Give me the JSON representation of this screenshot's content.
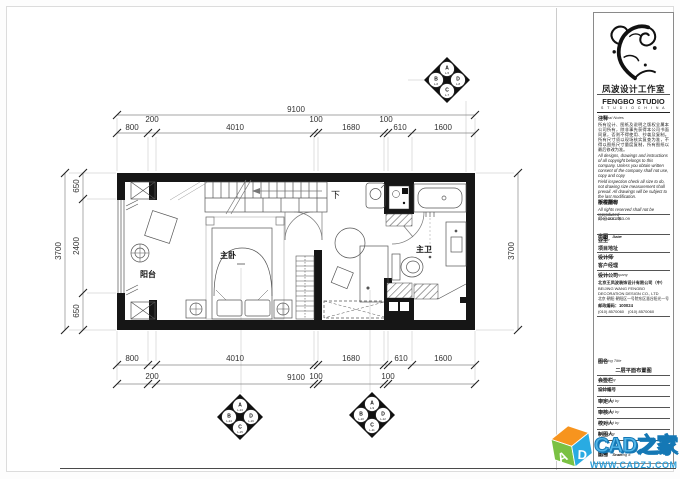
{
  "plan": {
    "rooms": {
      "balcony": "阳台",
      "bedroom": "主卧",
      "bathroom": "主卫",
      "stair_down": "下"
    },
    "dims": {
      "top": {
        "overall": "9100",
        "d800": "800",
        "d200": "200",
        "d4010": "4010",
        "d100a": "100",
        "d1680": "1680",
        "d100b": "100",
        "d610": "610",
        "d1600": "1600"
      },
      "bottom": {
        "overall": "9100",
        "d800": "800",
        "d200": "200",
        "d4010": "4010",
        "d100a": "100",
        "d1680": "1680",
        "d100b": "100",
        "d610": "610",
        "d1600": "1600"
      },
      "left": {
        "overall": "3700",
        "d650a": "650",
        "d2400": "2400",
        "d650b": "650"
      },
      "right": {
        "overall": "3700"
      }
    },
    "markers": {
      "top": {
        "n": "A",
        "n_code": "L-5",
        "w": "B",
        "w_code": "L-6",
        "e": "D",
        "e_code": "L-8",
        "s": "C",
        "s_code": "L-7"
      },
      "bottom_left": {
        "n": "A",
        "n_code": "L-13",
        "w": "B",
        "w_code": "L-14",
        "e": "D",
        "e_code": "L-16",
        "s": "C",
        "s_code": "L-15"
      },
      "bottom_right": {
        "n": "A",
        "n_code": "L-9",
        "w": "B",
        "w_code": "L-10",
        "e": "D",
        "e_code": "L-12",
        "s": "C",
        "s_code": "L-11"
      }
    }
  },
  "titleblock": {
    "studio_cn": "凤波设计工作室",
    "studio_en": "FENGBO  STUDIO",
    "studio_sub": "S T U D I O      C H I N A",
    "notes_label_cn": "注释",
    "notes_label_en": "General Notes",
    "notes_cn": "所有设计、图纸及说明之版权全属本公司所有，除非事先获得本公司书面同意，否则不得使用、抄袭及复制。所有尺寸须以现场核实复查为准，不得以图纸尺寸量度复制，所有图纸以最后修改为准。",
    "notes_en1": "All designs, drawings and instructions of all copyright belongs to this company. Unless you obtain written consent of the company shall not use, copy and copy",
    "notes_en2": "Field inspection check all size to do, not drawing size measurement shall prevail. All drawings will be subject to the last modification.",
    "copyright_cn_left": "版权所有",
    "copyright_cn_right": "不得翻印",
    "copyright_en": "All rights reserved shall not be reproduced",
    "doc_no": "506048JC 063-09",
    "doc_date": "月 日 2014年",
    "issue_cn": "出图",
    "issue_en": "Issue",
    "date_cn": "日期",
    "date_en": "Date",
    "owner_cn": "业主",
    "owner_en": "Owner",
    "owner_value": "项目地址",
    "designer_cn": "设计师",
    "designer_en": "Designer",
    "designer_value": "客户经理",
    "company_cn": "设计公司",
    "company_en": "Design company",
    "company_name_cn": "北京王凤波装饰设计有限公司（中）",
    "company_name_en1": "BEIJING  WANG FENGBO",
    "company_name_en2": "DECORATION  DESIGN  CO., LTD",
    "company_addr": "北京·朝阳·朝阳区一号院东区慧谷阳光一号",
    "company_zip": "邮政编码：100024",
    "company_tel": "(010) 8570060　(010) 8570060",
    "drawing_title_cn": "图名",
    "drawing_title_en": "Drawing Title",
    "drawing_title_value": "二层平面布置图",
    "signed_cn": "会签栏",
    "signed_en": "Signed by",
    "design_no_cn": "设计编号",
    "design_no_value": "SJ02#",
    "approved_cn": "审定人",
    "approved_en": "Checked by",
    "checked_cn": "审核人",
    "checked_en": "Checked by",
    "proofread_cn": "校对人",
    "proofread_en": "Checked by",
    "drawn_cn": "制图人",
    "drawn_en": "Drawn by",
    "scale_cn": "比例",
    "scale_en": "Scale",
    "figure_no_cn": "图号",
    "figure_no_en": "Drawing #"
  },
  "watermark": {
    "brand": "CAD之家",
    "url": "WWW.CADZJ.COM",
    "cube_letter_a": "A",
    "cube_letter_d": "D"
  }
}
